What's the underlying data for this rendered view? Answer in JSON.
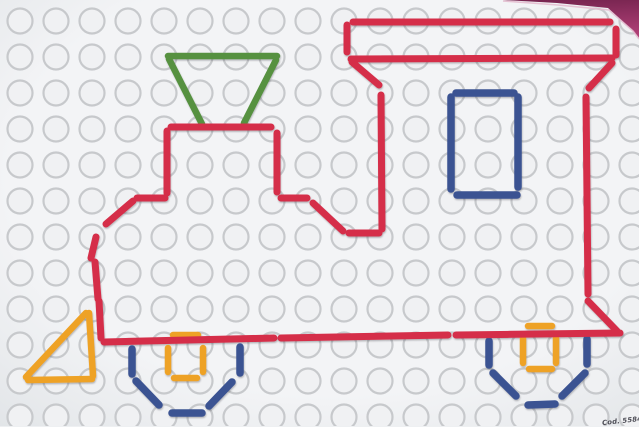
{
  "meta": {
    "code_label": "Cod. 5584"
  },
  "palette": {
    "red": "#d52e49",
    "green": "#569140",
    "blue": "#3a5292",
    "orange": "#eea227",
    "bg_center": "#f3f4f6",
    "bg_edge": "#e2e5e8",
    "hole_stroke": "#c7c9cc",
    "hole_fill": "#f0f1f3",
    "backdrop_dark": "#76244f",
    "backdrop_light": "#b04077",
    "backdrop_edge_highlight": "#e3bccf",
    "shadow": "#30343a"
  },
  "board": {
    "grid": {
      "cols": 18,
      "rows": 12,
      "x0": 20,
      "y0": 21,
      "pitch": 36,
      "radius": 12.5,
      "stroke_width": 2.2
    },
    "backdrop_wedge_points": "503,0 639,0 639,38 632,30 608,8 557,3",
    "backdrop_edge_points": "503,1 558,5 609,10 633,31 639,39"
  },
  "figure": {
    "subject": "steam-locomotive-peg-outline",
    "stroke_widths": {
      "red": 7,
      "green": 6.5,
      "blue": 7.5,
      "orange": 6.5
    },
    "layers": [
      {
        "color_key": "orange",
        "segments": [
          [
            89,
            313,
            93,
            376
          ],
          [
            28,
            380,
            92,
            379
          ],
          [
            26,
            377,
            86,
            313
          ],
          [
            173,
            335,
            198,
            335
          ],
          [
            168,
            348,
            168,
            372
          ],
          [
            203,
            348,
            203,
            372
          ],
          [
            174,
            378,
            197,
            378
          ],
          [
            528,
            326,
            552,
            326
          ],
          [
            523,
            338,
            523,
            363
          ],
          [
            556,
            338,
            556,
            363
          ],
          [
            529,
            369,
            552,
            369
          ]
        ]
      },
      {
        "color_key": "blue",
        "segments": [
          [
            456,
            93,
            514,
            93
          ],
          [
            451,
            97,
            451,
            189
          ],
          [
            518,
            97,
            518,
            187
          ],
          [
            457,
            195,
            517,
            195
          ],
          [
            132,
            349,
            132,
            374
          ],
          [
            136,
            381,
            159,
            405
          ],
          [
            172,
            413,
            202,
            413
          ],
          [
            209,
            406,
            232,
            382
          ],
          [
            240,
            347,
            240,
            373
          ],
          [
            489,
            341,
            489,
            365
          ],
          [
            493,
            373,
            516,
            396
          ],
          [
            528,
            405,
            555,
            404
          ],
          [
            562,
            396,
            585,
            373
          ],
          [
            587,
            339,
            587,
            364
          ]
        ]
      },
      {
        "color_key": "green",
        "segments": [
          [
            168,
            56,
            277,
            56
          ],
          [
            169,
            59,
            202,
            124
          ],
          [
            276,
            60,
            244,
            123
          ]
        ]
      },
      {
        "color_key": "red",
        "segments": [
          [
            353,
            22,
            610,
            22
          ],
          [
            347,
            25,
            347,
            52
          ],
          [
            616,
            29,
            616,
            55
          ],
          [
            351,
            59,
            612,
            58
          ],
          [
            352,
            62,
            379,
            85
          ],
          [
            612,
            63,
            589,
            88
          ],
          [
            381,
            95,
            382,
            229
          ],
          [
            586,
            97,
            588,
            294
          ],
          [
            171,
            127,
            271,
            127
          ],
          [
            167,
            131,
            167,
            193
          ],
          [
            277,
            133,
            277,
            192
          ],
          [
            137,
            198,
            165,
            198
          ],
          [
            281,
            198,
            307,
            198
          ],
          [
            313,
            203,
            343,
            231
          ],
          [
            349,
            233,
            379,
            233
          ],
          [
            133,
            201,
            106,
            224
          ],
          [
            96,
            237,
            91,
            258
          ],
          [
            95,
            262,
            98,
            299
          ],
          [
            99,
            301,
            101,
            338
          ],
          [
            104,
            342,
            274,
            338
          ],
          [
            281,
            338,
            448,
            335
          ],
          [
            456,
            335,
            620,
            333
          ],
          [
            588,
            301,
            617,
            331
          ]
        ]
      }
    ]
  }
}
